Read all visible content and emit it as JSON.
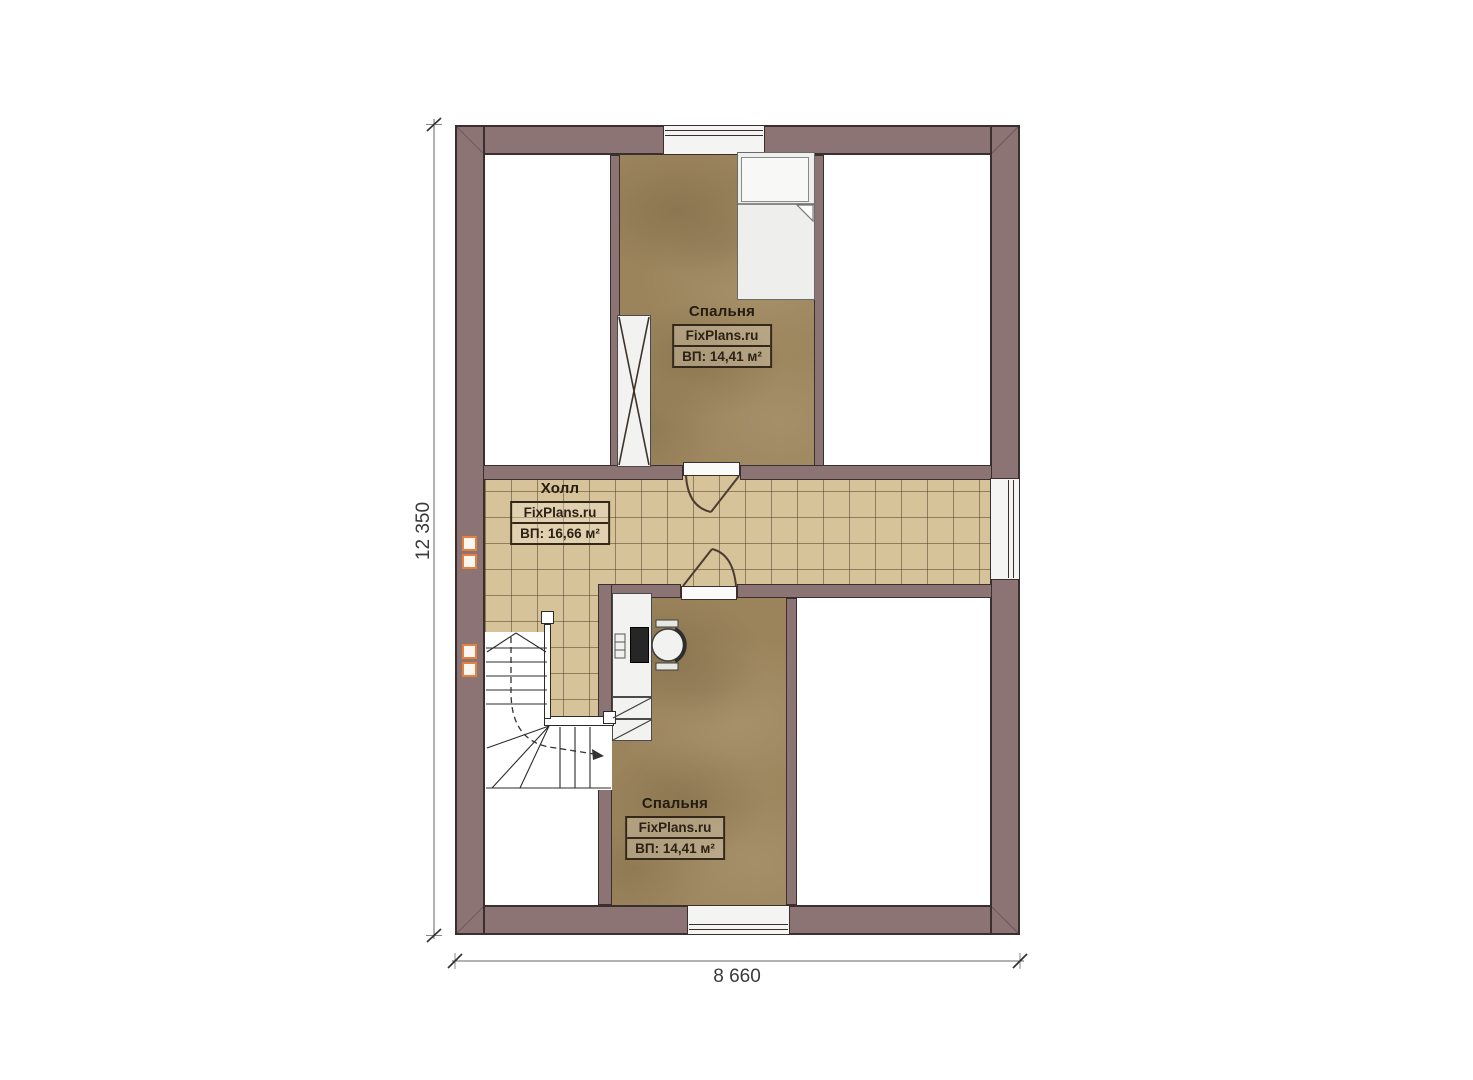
{
  "plan": {
    "rooms": [
      {
        "name": "Спальня",
        "brand": "FixPlans.ru",
        "area": "ВП: 14,41 м²"
      },
      {
        "name": "Холл",
        "brand": "FixPlans.ru",
        "area": "ВП: 16,66 м²"
      },
      {
        "name": "Спальня",
        "brand": "FixPlans.ru",
        "area": "ВП: 14,41 м²"
      }
    ],
    "dimensions": {
      "height": "12 350",
      "width": "8 660"
    },
    "colors": {
      "wall": "#8c7474",
      "wall_outline": "#3b2e2e",
      "tile_floor": "#d7c39a",
      "wood_floor": "#9b845c",
      "vent_accent": "#e4813e"
    }
  }
}
